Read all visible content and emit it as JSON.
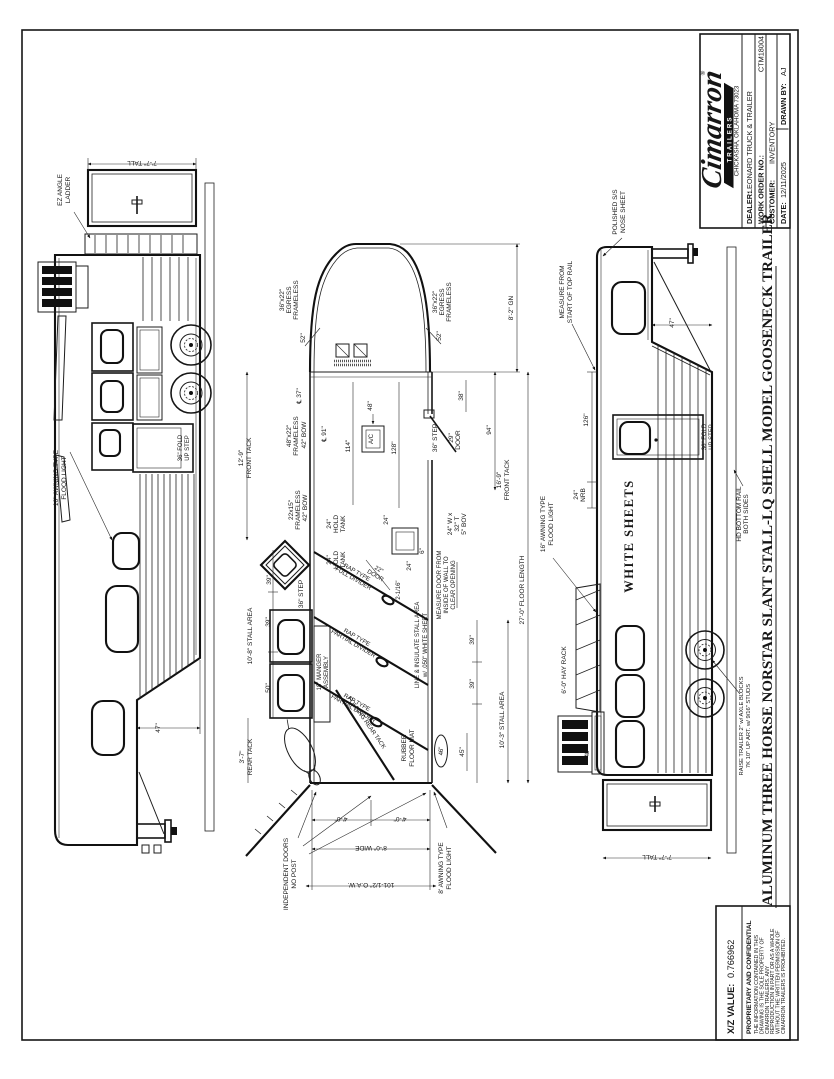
{
  "title_block": {
    "brand": "Cimarron",
    "brand_sub": "TRAILERS",
    "brand_reg": "®",
    "address": "CHICKASHA, OKLAHOMA 73023",
    "dealer_label": "DEALER:",
    "dealer_value": "LEONARD TRUCK & TRAILER",
    "work_order_label": "WORK ORDER NO.:",
    "work_order_value": "CTM18004",
    "customer_label": "CUSTOMER:",
    "customer_value": "INVENTORY",
    "date_label": "DATE:",
    "date_value": "12/11/2025",
    "drawn_by_label": "DRAWN BY:",
    "drawn_by_value": "AJ"
  },
  "drawing_title": "ALUMINUM THREE HORSE NORSTAR SLANT STALL-LQ SHELL MODEL GOOSENECK TRAILER",
  "footer": {
    "xz_label": "X/Z VALUE:",
    "xz_value": "0.766962",
    "proprietary_title": "PROPRIETARY AND CONFIDENTIAL",
    "proprietary_lines": [
      "THE INFORMATION CONTAINED IN THIS",
      "DRAWING IS THE SOLE PROPERTY OF",
      "CIMARRON TRAILERS.  ANY",
      "REPRODUCTION IN PART OR AS A WHOLE",
      "WITHOUT THE WRITTEN PERMISSION OF",
      "CIMARRON TRAILERS IS PROHIBITED."
    ]
  },
  "left_view": {
    "tall_dim": "7'-7\" TALL",
    "ladder_l1": "EZ ANGLE",
    "ladder_l2": "LADDER",
    "flood_l1": "16\" AWNING TYPE",
    "flood_l2": "FLOOD LIGHT",
    "fold_step_l1": "36\" FOLD",
    "fold_step_l2": "UP STEP",
    "drop_dim": "47\""
  },
  "floor_plan": {
    "egress_size": "36\"x22\"",
    "egress_l2": "EGRESS",
    "egress_l3": "FRAMELESS",
    "egress_dim": "52\"",
    "gn_dim": "8'-2\" GN",
    "cl37": "℄ 37\"",
    "fr48_l1": "48\"x22\"",
    "fr48_l2": "FRAMELESS",
    "fr48_l3": "42\" BOW",
    "cl91": "℄ 91\"",
    "dim114": "114\"",
    "dim48": "48\"",
    "ac": "A/C",
    "dim128": "128\"",
    "step36": "36\" STEP",
    "door29": "29\"",
    "door_word": "DOOR",
    "dim38": "38\"",
    "dim94": "94\"",
    "front_tack_129_l1": "12'-9\"",
    "front_tack_129_l2": "FRONT TACK",
    "fr2215_l1": "22x15\"",
    "fr2215_l2": "FRAMELESS",
    "fr2215_l3": "42\" BOW",
    "hold_dim": "24\"",
    "hold_l1": "HOLD",
    "hold_l2": "TANK",
    "tank24": "24\"",
    "dim6": "6\"",
    "bov_l1": "24\" W x",
    "bov_l2": "32\" T",
    "bov_l3": "5\" BOV",
    "front_tack_169_l1": "16'-9\"",
    "front_tack_169_l2": "FRONT TACK",
    "dim39": "39\"",
    "dim50": "50\"",
    "dim45": "45\"",
    "dim46": "46\"",
    "stall_area_108": "10'-8\" STALL AREA",
    "stall_area_103": "10'-3\" STALL AREA",
    "manger_l1": "18\" MANGER",
    "manger_l2": "ASSEMBLY",
    "door22_l1": "22\"",
    "door22_l2": "DOOR",
    "dim2116": "2-1/16\"",
    "full_div_l1": "RAP TYPE",
    "full_div_l2": "FULL DIVIDER",
    "part_div_l1": "RAP TYPE",
    "part_div_l2": "PARTIAL DIVIDER",
    "measure_l1": "MEASURE DOOR FROM",
    "measure_l2": "INSIDE OF WALL TO",
    "measure_l3": "CLEAR OPENING",
    "insulate_l1": "LINE & INSULATE STALL AREA",
    "insulate_l2": "w/ .050\" WHITE SHEET",
    "rubber_l1": "RUBBER",
    "rubber_l2": "FLOOR MAT",
    "rear_tack_l1": "3'-7\"",
    "rear_tack_l2": "REAR TACK",
    "folding_rear": "FOLDING REAR TACK",
    "indep_l1": "INDEPENDENT DOORS",
    "indep_l2": "NO POST",
    "dim40": "4'-0\"",
    "wide": "8'-0\" WIDE",
    "oaw": "101-1/2\" O.A.W.",
    "awning8_l1": "8' AWNING TYPE",
    "awning8_l2": "FLOOD LIGHT",
    "floor_length": "27'-0\" FLOOR LENGTH"
  },
  "right_view": {
    "polished_l1": "POLISHED S/S",
    "polished_l2": "NOSE SHEET",
    "measure_l1": "MEASURE FROM",
    "measure_l2": "START OF TOP RAIL",
    "drop_dim": "47\"",
    "dim126": "126\"",
    "nrb_l1": "24\"",
    "nrb_l2": "NRB",
    "white_sheets": "WHITE SHEETS",
    "fold_step_l1": "36\" FOLD",
    "fold_step_l2": "UP STEP",
    "flood_l1": "16\" AWNING TYPE",
    "flood_l2": "FLOOD LIGHT",
    "hay_rack": "6'-0\" HAY RACK",
    "dim48": "48\"",
    "hd_rail_l1": "HD BOTTOM RAIL",
    "hd_rail_l2": "BOTH SIDES",
    "raise_l1": "RAISE TRAILER 2\" w/ AXLE BLOCKS",
    "raise_l2": "7K 10\" UP ART. w/ 9/16\" STUDS",
    "tall_dim": "7'-7\" TALL"
  }
}
